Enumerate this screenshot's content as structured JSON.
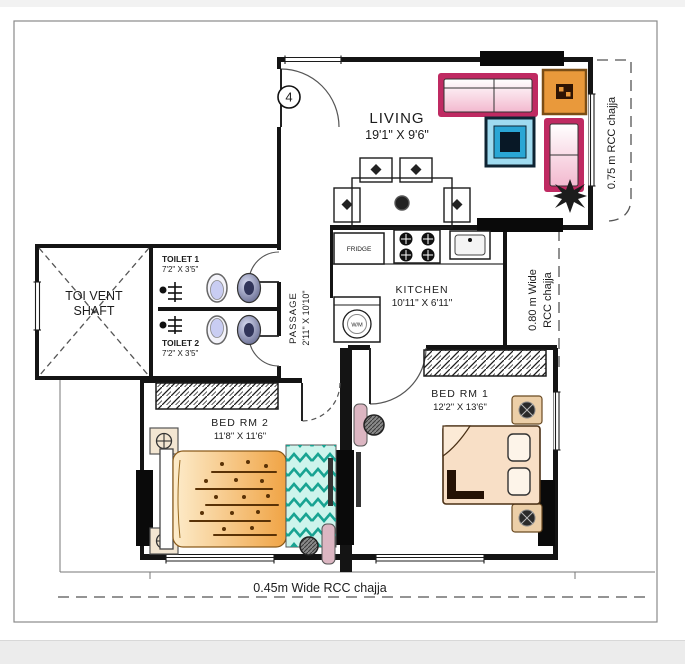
{
  "plan": {
    "marker": "4",
    "rooms": {
      "living": {
        "name": "LIVING",
        "dim": "19'1\" X 9'6\""
      },
      "kitchen": {
        "name": "KITCHEN",
        "dim": "10'11\" X 6'11\""
      },
      "passage": {
        "name": "PASSAGE",
        "dim": "2'11\" X 10'10\""
      },
      "toilet1": {
        "name": "TOILET 1",
        "dim": "7'2\" X 3'5\""
      },
      "toilet2": {
        "name": "TOILET 2",
        "dim": "7'2\" X 3'5\""
      },
      "vent_shaft": {
        "line1": "TOI VENT",
        "line2": "SHAFT"
      },
      "bed2": {
        "name": "BED RM 2",
        "dim": "11'8\" X 11'6\""
      },
      "bed1": {
        "name": "BED RM 1",
        "dim": "12'2\" X 13'6\""
      }
    },
    "appliances": {
      "fridge": "FRIDGE",
      "washing_machine": "W/M"
    },
    "annotations": {
      "chajja_right": "0.75 m RCC chajja",
      "chajja_kitchen_line1": "0.80 m Wide",
      "chajja_kitchen_line2": "RCC chajja",
      "chajja_bottom": "0.45m Wide RCC chajja"
    },
    "colors": {
      "wall": "#141414",
      "sofa_stroke": "#bf2a62",
      "sofa_fill": "#f6c3d6",
      "corner_table": "#e9993b",
      "center_table_mid": "#2aa6d5",
      "center_table_core": "#0a1b2e",
      "bed2_fill": "#f0a445",
      "rug_teal": "#18a392",
      "bed1_fill": "#f8dfc6"
    }
  }
}
